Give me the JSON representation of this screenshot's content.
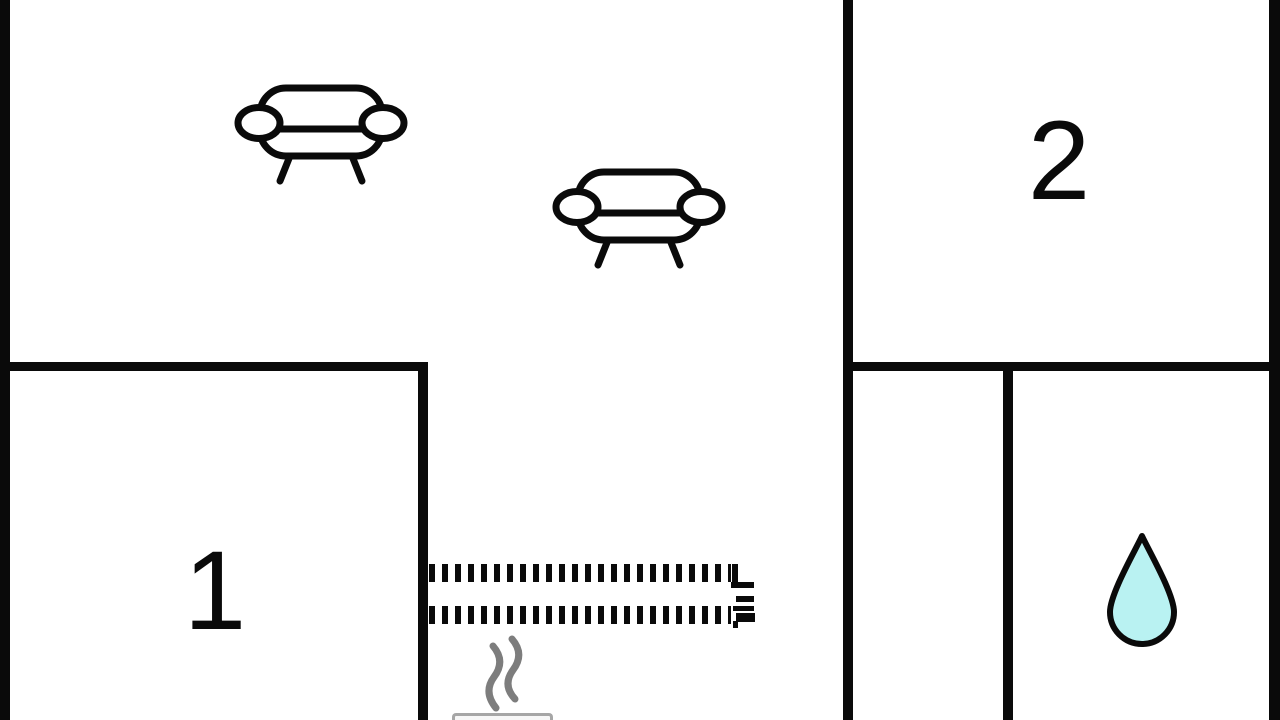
{
  "rooms": [
    {
      "id": "room-1",
      "label": "1"
    },
    {
      "id": "room-2",
      "label": "2"
    }
  ],
  "icons": {
    "living_area": [
      "sofa-icon",
      "sofa-icon"
    ],
    "bathroom": "water-drop-icon",
    "sauna": "steam-icon",
    "heater": "stove-icon",
    "partition": "dashed-partition"
  },
  "colors": {
    "background": "#ffffff",
    "wall": "#0a0a0a",
    "drop_fill": "#b9f2f2",
    "steam": "#7d7d7d",
    "stove_border": "#a6a6a6"
  }
}
